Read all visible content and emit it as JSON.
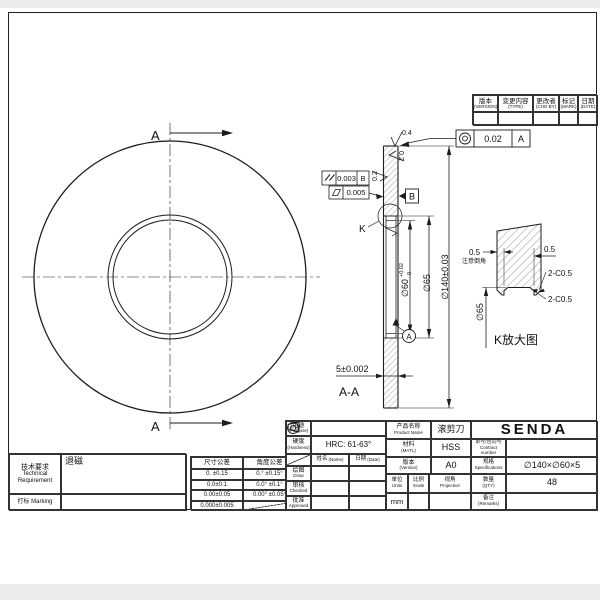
{
  "drawing": {
    "section_label": "A",
    "section_title": "A-A",
    "detail_letter": "K",
    "detail_title": "K放大图"
  },
  "dims": {
    "outer": "∅140±0.03",
    "counterbore": "∅65",
    "bore": "∅60",
    "bore_tol_up": "+0.02",
    "bore_tol_dn": "0",
    "thickness": "5±0.002",
    "roughness_top": "0.4",
    "roughness_left": "0.2",
    "roughness_right": "0.2"
  },
  "gdt": {
    "parallelism_value": "0.003",
    "parallelism_datum": "B",
    "flatness_value": "0.005",
    "concentricity_value": "0.02",
    "concentricity_datum": "A",
    "datum_a": "A",
    "datum_b": "B"
  },
  "detail": {
    "dim_left": "0.5",
    "dim_right": "0.5",
    "chamfer_1": "2-C0.5",
    "chamfer_2": "2-C0.5",
    "note": "注意倒角",
    "bore": "∅65"
  },
  "revision_table": {
    "headers": [
      {
        "zh": "版本",
        "en": "(VERSION)"
      },
      {
        "zh": "变更内容",
        "en": "(TYPE)"
      },
      {
        "zh": "更改者",
        "en": "(CHG BY)"
      },
      {
        "zh": "标记",
        "en": "(MARK)"
      },
      {
        "zh": "日期",
        "en": "(DATE)"
      }
    ]
  },
  "tech_req": {
    "label_zh": "技术要求",
    "label_en1": "Technical",
    "label_en2": "Requirement",
    "value": "退磁",
    "marking": "打标 Marking"
  },
  "tolerance_table": {
    "headers": [
      "尺寸公差",
      "角度公差"
    ],
    "rows": [
      [
        "0. ±0.15",
        "0.° ±0.15°"
      ],
      [
        "0.0±0.1",
        "0.0° ±0.1°"
      ],
      [
        "0.00±0.05",
        "0.00° ±0.05°"
      ],
      [
        "0.000±0.005",
        ""
      ]
    ]
  },
  "title_block": {
    "purpose_zh": "用途",
    "purpose_en": "(Purpose)",
    "hardness_zh": "硬度",
    "hardness_en": "(Hardness)",
    "hardness_value": "HRC: 61-63°",
    "name_zh": "姓名",
    "name_en": "(Name)",
    "date_zh": "日期",
    "date_en": "(Date)",
    "draw_zh": "绘图",
    "draw_en": "Draw",
    "checked_zh": "审核",
    "checked_en": "Checked",
    "approved_zh": "批准",
    "approved_en": "Approved",
    "product_zh": "产品名称",
    "product_en": "Product Name",
    "product_value": "滚剪刀",
    "company": "SENDA",
    "material_zh": "材料",
    "material_en": "(MATL)",
    "material_value": "HSS",
    "contract_zh": "单号/合同号",
    "contract_en": "Contract number",
    "contract_value": "",
    "version_zh": "版本",
    "version_en": "(Version)",
    "version_value": "A0",
    "spec_zh": "规格",
    "spec_en": "Specifications",
    "spec_value": "∅140×∅60×5",
    "units_zh": "单位",
    "units_en": "Units",
    "units_value": "mm",
    "scale_zh": "比例",
    "scale_en": "Scale",
    "scale_value": "",
    "view_zh": "视角",
    "view_en": "Projection",
    "qty_zh": "数量",
    "qty_en": "(QTY)",
    "qty_value": "48",
    "remarks_zh": "备注",
    "remarks_en": "(Remarks)",
    "remarks_value": ""
  }
}
